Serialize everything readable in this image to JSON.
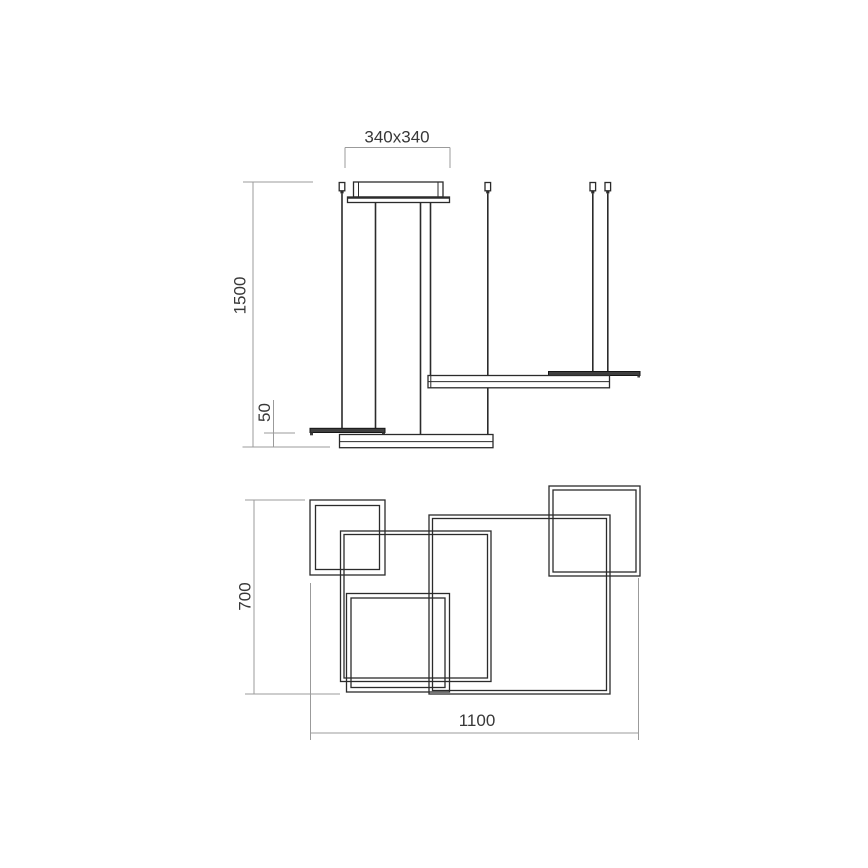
{
  "drawing": {
    "type": "technical-dimension-drawing",
    "subject": "square frames LED pendant lamp",
    "colors": {
      "background": "#ffffff",
      "line": "#2b2b2b",
      "dark_bar_fill": "#3f3f3f",
      "dimension_line": "#9b9b9b",
      "text": "#383838"
    },
    "elevation": {
      "dim_canopy": "340x340",
      "dim_drop": "1500",
      "dim_profile": "50"
    },
    "plan": {
      "dim_depth": "700",
      "dim_width": "1100"
    }
  }
}
